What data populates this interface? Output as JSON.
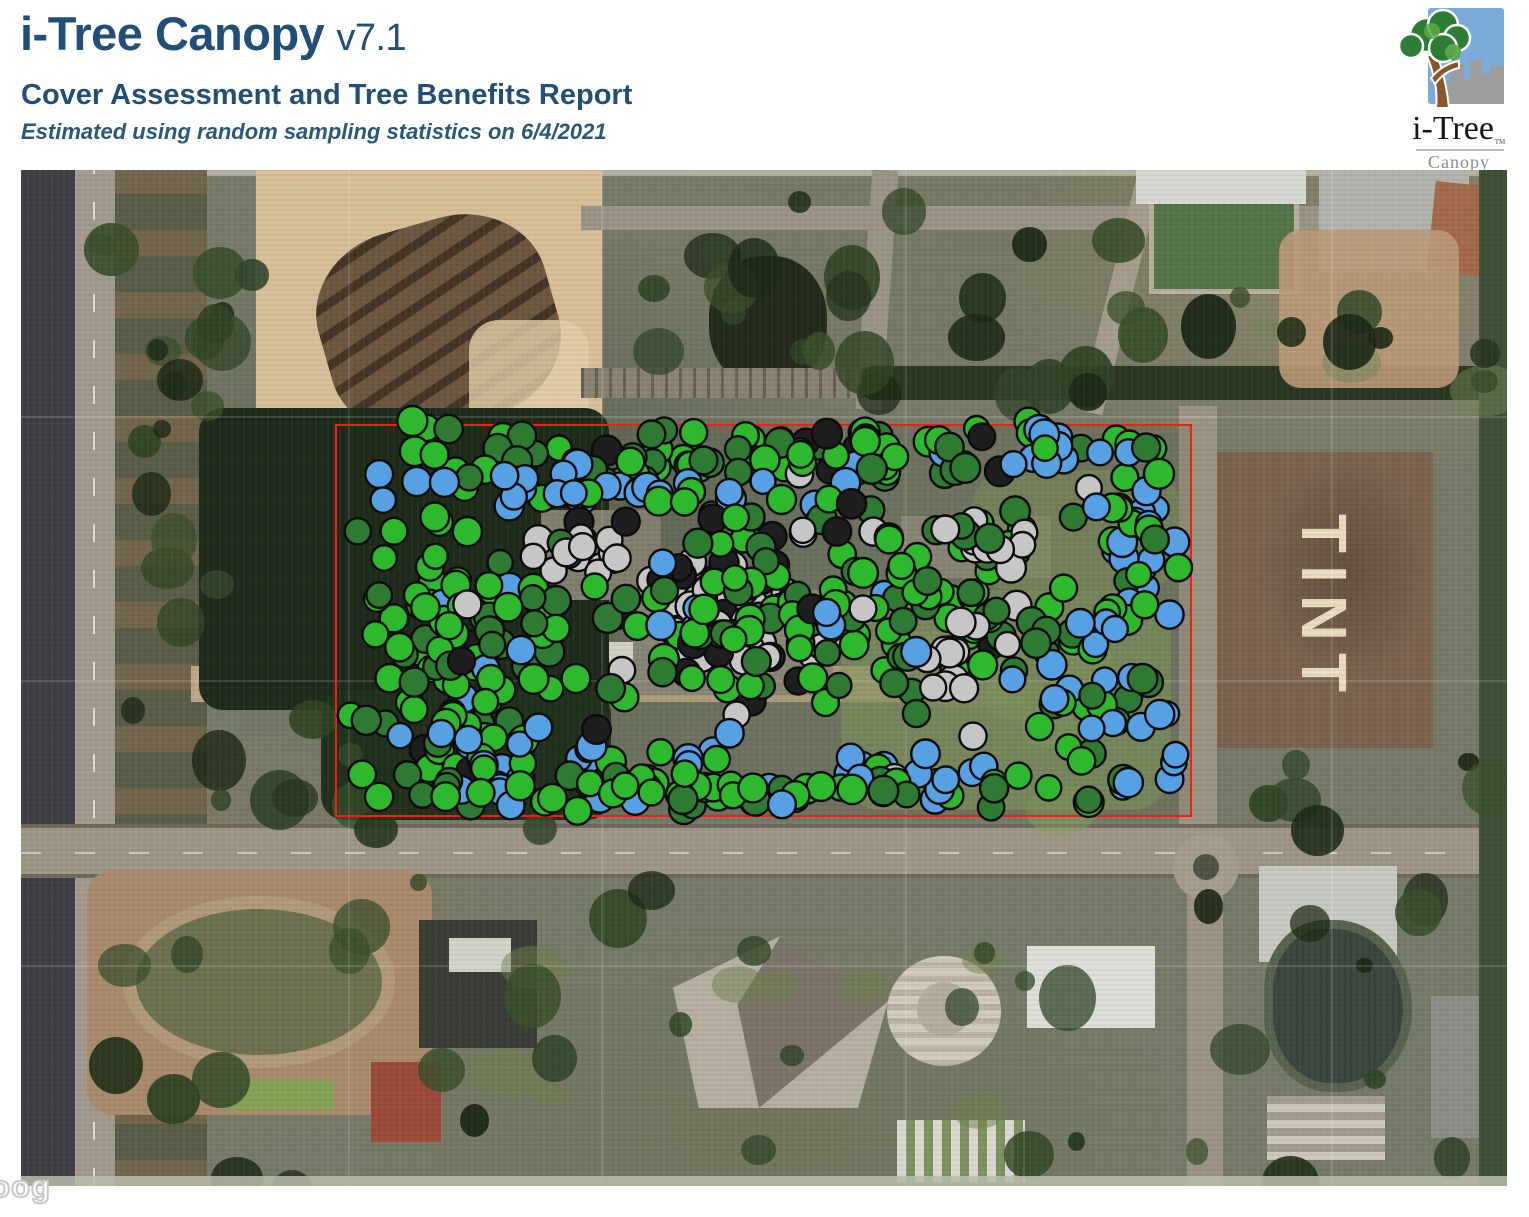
{
  "header": {
    "title": "i-Tree Canopy",
    "version": "v7.1",
    "subtitle": "Cover Assessment and Tree Benefits Report",
    "note": "Estimated using random sampling statistics on 6/4/2021",
    "text_color": "#224f78"
  },
  "logo": {
    "brand": "i-Tree",
    "trademark": "TM",
    "product": "Canopy"
  },
  "map": {
    "field_label": "TINT",
    "watermark_fragment": "Goog",
    "boundary_color": "#ee2214",
    "boundary_rect": {
      "left": 314,
      "top": 254,
      "width": 857,
      "height": 393
    },
    "point_style": {
      "radius_min": 12.5,
      "radius_max": 15,
      "stroke": "#0c0c0c",
      "stroke_width": 2.4
    },
    "sample_point_classes": {
      "tree": {
        "color": "#2eb82e"
      },
      "shrub": {
        "color": "#2f7a32"
      },
      "water": {
        "color": "#58a0e4"
      },
      "impervious": {
        "color": "#c6c6c6"
      },
      "shadow": {
        "color": "#1e1e1e"
      }
    },
    "clusters": [
      {
        "name": "top-green-band",
        "x": 316,
        "y": 248,
        "w": 850,
        "h": 75,
        "count": 88,
        "mix": {
          "tree": 0.5,
          "shrub": 0.36,
          "shadow": 0.08,
          "impervious": 0.03,
          "water": 0.03
        }
      },
      {
        "name": "upper-blue-wave",
        "x": 345,
        "y": 288,
        "w": 555,
        "h": 65,
        "count": 36,
        "mix": {
          "water": 0.84,
          "tree": 0.1,
          "shrub": 0.06
        }
      },
      {
        "name": "topright-blue",
        "x": 975,
        "y": 258,
        "w": 125,
        "h": 55,
        "count": 15,
        "mix": {
          "water": 0.87,
          "tree": 0.13
        }
      },
      {
        "name": "right-blue-column",
        "x": 1078,
        "y": 268,
        "w": 90,
        "h": 195,
        "count": 24,
        "mix": {
          "water": 0.75,
          "tree": 0.15,
          "shrub": 0.1
        }
      },
      {
        "name": "left-green-mix",
        "x": 316,
        "y": 330,
        "w": 250,
        "h": 315,
        "count": 105,
        "mix": {
          "tree": 0.56,
          "shrub": 0.26,
          "water": 0.13,
          "shadow": 0.05
        }
      },
      {
        "name": "center-gray-upper",
        "x": 495,
        "y": 348,
        "w": 120,
        "h": 58,
        "count": 17,
        "mix": {
          "impervious": 0.8,
          "shadow": 0.1,
          "shrub": 0.1
        }
      },
      {
        "name": "center-gray-main",
        "x": 612,
        "y": 386,
        "w": 218,
        "h": 126,
        "count": 40,
        "mix": {
          "impervious": 0.78,
          "shadow": 0.08,
          "tree": 0.07,
          "shrub": 0.07
        }
      },
      {
        "name": "center-shadow",
        "x": 558,
        "y": 330,
        "w": 305,
        "h": 230,
        "count": 20,
        "mix": {
          "shadow": 0.75,
          "shrub": 0.15,
          "impervious": 0.1
        }
      },
      {
        "name": "mid-green-field",
        "x": 560,
        "y": 318,
        "w": 610,
        "h": 245,
        "count": 125,
        "mix": {
          "tree": 0.5,
          "shrub": 0.36,
          "impervious": 0.06,
          "water": 0.05,
          "shadow": 0.03
        }
      },
      {
        "name": "right-gray-upper",
        "x": 895,
        "y": 342,
        "w": 135,
        "h": 62,
        "count": 15,
        "mix": {
          "impervious": 0.74,
          "shadow": 0.13,
          "shrub": 0.13
        }
      },
      {
        "name": "right-gray-lower",
        "x": 872,
        "y": 450,
        "w": 120,
        "h": 90,
        "count": 13,
        "mix": {
          "impervious": 0.7,
          "tree": 0.15,
          "shrub": 0.15
        }
      },
      {
        "name": "bottom-blue-left",
        "x": 345,
        "y": 555,
        "w": 410,
        "h": 88,
        "count": 40,
        "mix": {
          "water": 0.66,
          "tree": 0.24,
          "shrub": 0.1
        }
      },
      {
        "name": "bottom-blue-mid",
        "x": 793,
        "y": 575,
        "w": 178,
        "h": 68,
        "count": 17,
        "mix": {
          "water": 0.72,
          "tree": 0.18,
          "impervious": 0.1
        }
      },
      {
        "name": "right-blue-block",
        "x": 1008,
        "y": 428,
        "w": 162,
        "h": 218,
        "count": 32,
        "mix": {
          "water": 0.62,
          "tree": 0.22,
          "shrub": 0.16
        }
      },
      {
        "name": "bottom-green-band",
        "x": 316,
        "y": 596,
        "w": 852,
        "h": 52,
        "count": 52,
        "mix": {
          "tree": 0.5,
          "shrub": 0.34,
          "water": 0.1,
          "shadow": 0.06
        }
      },
      {
        "name": "whole-rect-scatter",
        "x": 316,
        "y": 254,
        "w": 852,
        "h": 392,
        "count": 38,
        "mix": {
          "tree": 0.45,
          "shrub": 0.3,
          "water": 0.1,
          "impervious": 0.08,
          "shadow": 0.07
        }
      }
    ]
  }
}
